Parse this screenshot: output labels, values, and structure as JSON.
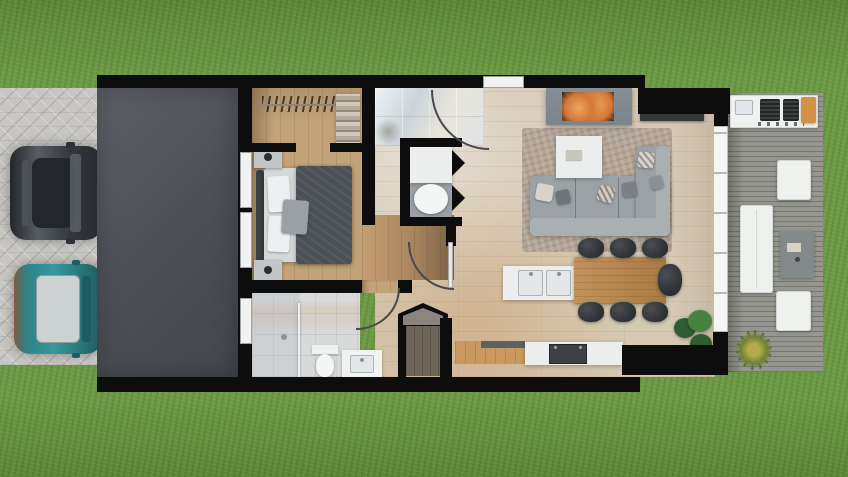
{
  "scene": {
    "type": "architectural floor plan",
    "view": "top-down 3D render",
    "description": "Photoreal top-down rendering of a small modern single-storey house: paver driveway with two parked cars, flat dark garage roof, bedroom with walk-in closet, bathroom, laundry closet, storage closet, open-plan kitchen / dining / living area with fireplace, and a side wood deck with outdoor kitchen and furniture, all set in a green lawn",
    "rooms": [
      "driveway",
      "garage",
      "walk-in-closet",
      "bedroom",
      "bathroom",
      "laundry-closet",
      "storage-closet",
      "hallway",
      "kitchen",
      "dining-area",
      "living-room",
      "entry",
      "deck"
    ],
    "furniture": [
      "double bed",
      "2 nightstands with lamps",
      "closet rod with hangers",
      "folded-clothes shelf",
      "sofa sectional with chaise",
      "6 throw pillows",
      "area rug",
      "coffee table",
      "fireplace",
      "tv console",
      "kitchen wall counters",
      "kitchen island with double sink",
      "range counter with oven",
      "dining table",
      "7 dining chairs",
      "toilet",
      "shower with glass screen",
      "vanity sink",
      "washer / round basin",
      "bbq grill counter with cutting board",
      "outdoor dining table",
      "2 outdoor chairs",
      "outdoor side table with tray",
      "indoor monstera plant",
      "deck ornamental grass"
    ],
    "vehicles": [
      {
        "type": "hatchback car",
        "body_color": "#35393e"
      },
      {
        "type": "hatchback car",
        "body_color": "#2e8286",
        "roof_color": "#ccd1d2"
      }
    ]
  },
  "counts": {
    "dining_chairs": 7,
    "outdoor_chairs": 2,
    "cars": 2,
    "bedroom_windows": 2,
    "bathroom_windows": 1
  },
  "colors": {
    "grass": "#6d9a45",
    "paver": "#c7c6c3",
    "slab": "#5d6066",
    "slabDark": "#43464c",
    "wall": "#0d0d0d",
    "oak": "#c2a277",
    "oakDark": "#7c6248",
    "tileBath": "#d8dadb",
    "livingFloor": "#d5c9b4",
    "deck": "#94968f",
    "glass": "#f4f5f4",
    "frame": "#b9bcba",
    "white": "#f2f3f1",
    "counterGloss": "#ccd4d9",
    "counterWhite": "#eceeed",
    "sinkSteel": "#e4e7e9",
    "steelLine": "#aeb3b6",
    "tableWood": "#c2925c",
    "tableWoodDark": "#a87a44",
    "chair": "#2c2f33",
    "sofa": "#9ba1a4",
    "sofaLight": "#aab0b2",
    "rug": "#b2a496",
    "fireplaceSurround": "#7b848b",
    "firebox": "#1a1712",
    "flame": "#d4763a",
    "flameLight": "#eaa55c",
    "tv": "#141517",
    "console": "#34373a",
    "mattress": "#d6d9da",
    "blanket": "#4b5056",
    "pillow": "#edeff0",
    "headboard": "#3a3f45",
    "nightstand": "#c3c6c8",
    "lamp": "#2c2f32",
    "carDark": "#35393e",
    "carDarkHi": "#565c63",
    "carGlass": "#23262a",
    "carTeal": "#2e8286",
    "carTealDark": "#1d5c60",
    "carRoof": "#ccd1d2",
    "plantGreen": "#2f5c33",
    "plantGreenLight": "#47803f",
    "grassPlant": "#b3ab4c",
    "grassPlantDark": "#6f8336",
    "storageFloor": "#6e655b",
    "powderFloor": "#9aa0a5",
    "orangeBoard": "#d49249",
    "stove": "#3e4144",
    "woodCab": "#c9995f",
    "arcLine": "#4a4a4a"
  }
}
